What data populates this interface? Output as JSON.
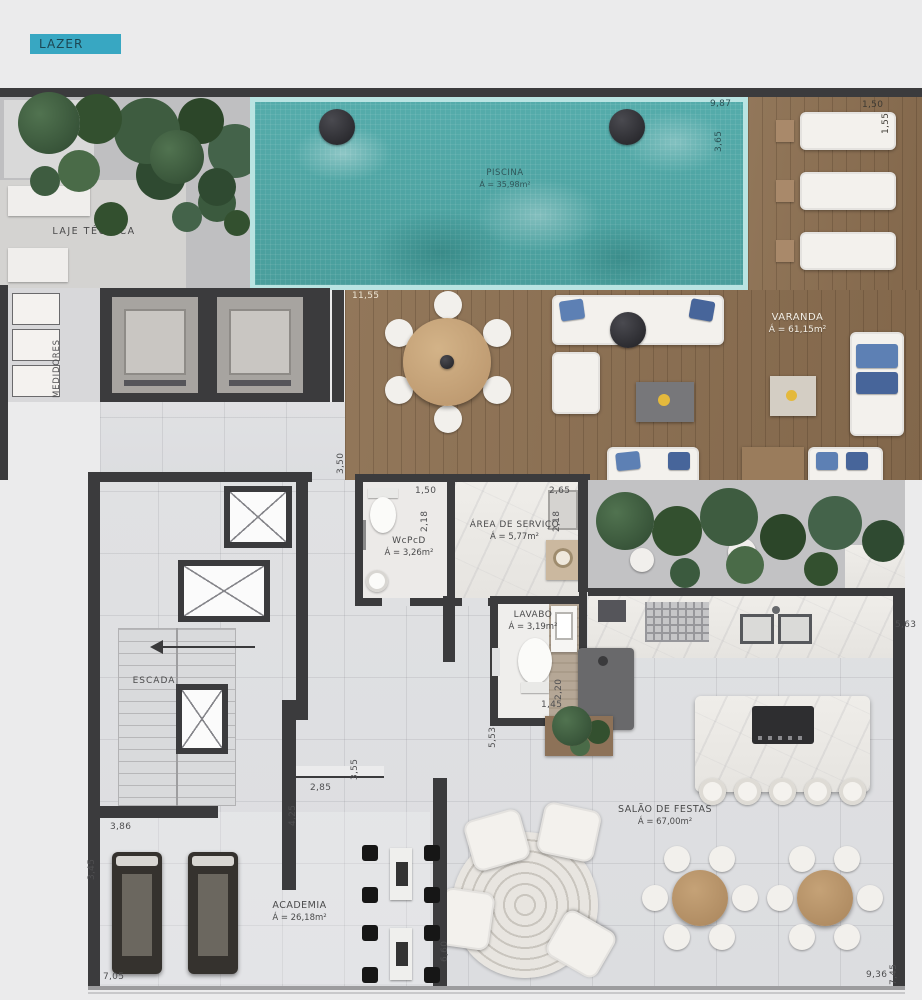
{
  "badge": {
    "label": "LAZER",
    "bg_color": "#38a7c2"
  },
  "rooms": {
    "laje_tecnica": {
      "name": "LAJE TÉCNICA"
    },
    "medidores": {
      "name": "MEDIDORES"
    },
    "piscina": {
      "name": "PISCINA",
      "area": "Á = 35,98m²"
    },
    "varanda": {
      "name": "VARANDA",
      "area": "Á = 61,15m²"
    },
    "wcpcd": {
      "name": "WcPcD",
      "area": "Á = 3,26m²"
    },
    "area_servico": {
      "name": "ÁREA DE SERVIÇO",
      "area": "Á = 5,77m²"
    },
    "lavabo": {
      "name": "LAVABO",
      "area": "Á = 3,19m²"
    },
    "escada": {
      "name": "ESCADA"
    },
    "salao_festas": {
      "name": "SALÃO DE FESTAS",
      "area": "Á = 67,00m²"
    },
    "academia": {
      "name": "ACADEMIA",
      "area": "Á = 26,18m²"
    }
  },
  "dimensions": {
    "pool_bottom": "11,55",
    "pool_right_a": "9,87",
    "pool_right_b": "3,65",
    "deck_top": "1,50",
    "deck_right": "1,55",
    "hall_left": "3,50",
    "wcpcd_width": "1,50",
    "wcpcd_depth": "2,18",
    "servico_width": "2,65",
    "servico_depth": "2,18",
    "lavabo_hall": "5,53",
    "lavabo_depth": "2,20",
    "lavabo_width": "1,45",
    "counter_right": "5,63",
    "hall_step": "3,55",
    "hall_width": "2,85",
    "hall_depth": "4,25",
    "academia_width": "3,86",
    "academia_left": "3,45",
    "academia_bottom": "7,05",
    "salao_bottom": "9,36",
    "salao_right": "7,45",
    "salao_left": "6,60"
  },
  "colors": {
    "badge_teal": "#38a7c2",
    "pool_water": "#4fa9a6",
    "pool_edge": "#b9e4e2",
    "wall": "#3b3b3d",
    "wood_deck": "#8a6e52",
    "foliage_green": "#3d5940",
    "pillow_blue": "#5d80b4"
  }
}
